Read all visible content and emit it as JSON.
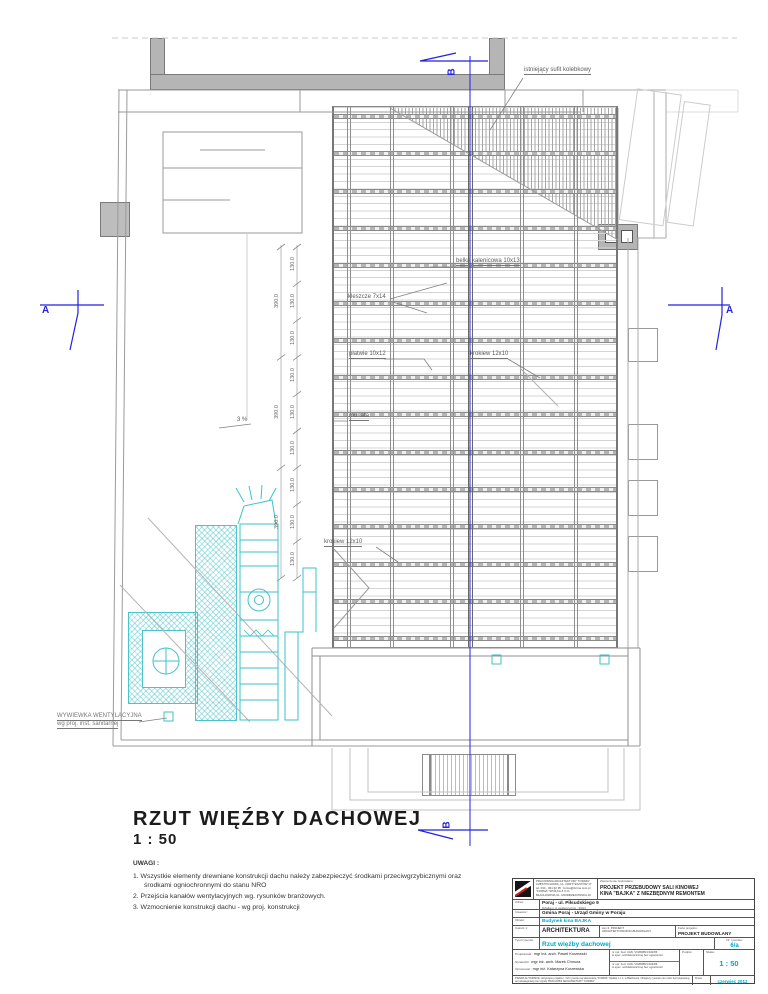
{
  "sheet": {
    "title": "RZUT WIĘŹBY DACHOWEJ",
    "scale": "1 : 50"
  },
  "notes": {
    "heading": "UWAGI :",
    "item1": "1.  Wszystkie elementy drewniane konstrukcji dachu należy zabezpieczyć środkami przeciwgrzybicznymi oraz środkami ogniochronnymi do stanu NRO",
    "item2": "2.  Przejścia kanałów wentylacyjnych wg. rysunków branżowych.",
    "item3": "3.  Wzmocnienie konstrukcji dachu - wg proj. konstrukcji"
  },
  "plan": {
    "labels": {
      "ceiling": "istniejący sufit kolebkowy",
      "ridge_beam": "belka kalenicowa 10x13",
      "collar_ties": "kleszcze 7x14",
      "purlins": "płatwie 10x12",
      "rafter_top": "krokiew 12x10",
      "wall_plate": "murłata",
      "rafter_bottom": "krokiew 12x10",
      "slope": "3 %",
      "vent_line1": "WYWIEWKA WENTYLACYJNA",
      "vent_line2": "wg proj. inst. sanitarnej"
    },
    "dimensions": {
      "bay": "130.0",
      "triple_bay": "390.0"
    },
    "sections": {
      "a": "A",
      "b": "B"
    },
    "colors": {
      "section_blue": "#2323dd",
      "vent_cyan": "#3fc2c8",
      "wall_gray": "#b5b5b5"
    }
  },
  "titleblock": {
    "office_line1": "PRACOWNIA ARCHITEKTURY \"FORMA\"",
    "office_line2": "CZĘSTOCHOWA, UL. PARTYZANTÓW 17",
    "office_line3": "tel. 034 - 361 62 95 ;  forma@forma.com.pl",
    "office_line4": "\"FORMA\" SPÓŁKA Z O.O.",
    "office_line5": "BŁACHOWNIA UL. MIODRZEJOWSKA 19",
    "venture_label": "Zamierzenie budowlane:",
    "venture_line1": "PROJEKT PRZEBUDOWY SALI KINOWEJ",
    "venture_line2": "KINA \"BAJKA\" Z NIEZBĘDNYM REMONTEM",
    "address_label": "Adres:",
    "address_value": "Poraj - ul. Piłsudskiego 9",
    "address_note": "Działka o nr ewidencyjnym : 990/1",
    "investor_label": "Inwestor:",
    "investor_value": "Gmina Poraj - Urząd Gminy w Poraju",
    "object_label": "Obiekt:",
    "object_value": "Budynek kina BAJKA",
    "part_label": "Całość 1:",
    "part_value": "ARCHITEKTURA",
    "volume_line1": "tom II. PROJEKT",
    "volume_line2": "ARCHITEKTONICZNO-BUDOWLANY",
    "phase_label": "Faza projektu:",
    "phase_value": "PROJEKT  BUDOWLANY",
    "drawing_title_label": "Tytuł rysunku:",
    "drawing_title": "Rzut więźby dachowej",
    "drawing_no_label": "Nr. rysunku:",
    "drawing_no": "6/a",
    "designed_label": "Projektował :",
    "designed_name": "mgr inż. arch. Paweł Korzewski",
    "checked_label": "Sprawdził :",
    "checked_name": "mgr inż. arch. Marek Chmura",
    "prepared_label": "Opracował :",
    "prepared_name": "mgr inż. Katarzyna Korzewska",
    "license1_line1": "nr upr. bud. UAN. VIII/8388/1/102/86",
    "license1_line2": "w spec. architektonicznej bez ograniczeń",
    "license2_line1": "nr upr. bud. UAN. VIII/8388/1/104/86",
    "license2_line2": "w spec. architektonicznej bez ograniczeń",
    "signature_label": "Podpis:",
    "scale_label": "Skala:",
    "scale_value": "1 : 50",
    "copyright": "PRAWA AUTORSKIE: dotyczące projektu i / lub rysunku są własnością \"FORMA\" Spółka z o.o. w Błachowni. Niniejszy rysunek nie może być kopiowany ani udostępniany bez zgody PRACOWNI ARCHITEKTURY \"FORMA\"",
    "date_label": "Data:",
    "date_value": "czerwiec 2012"
  }
}
